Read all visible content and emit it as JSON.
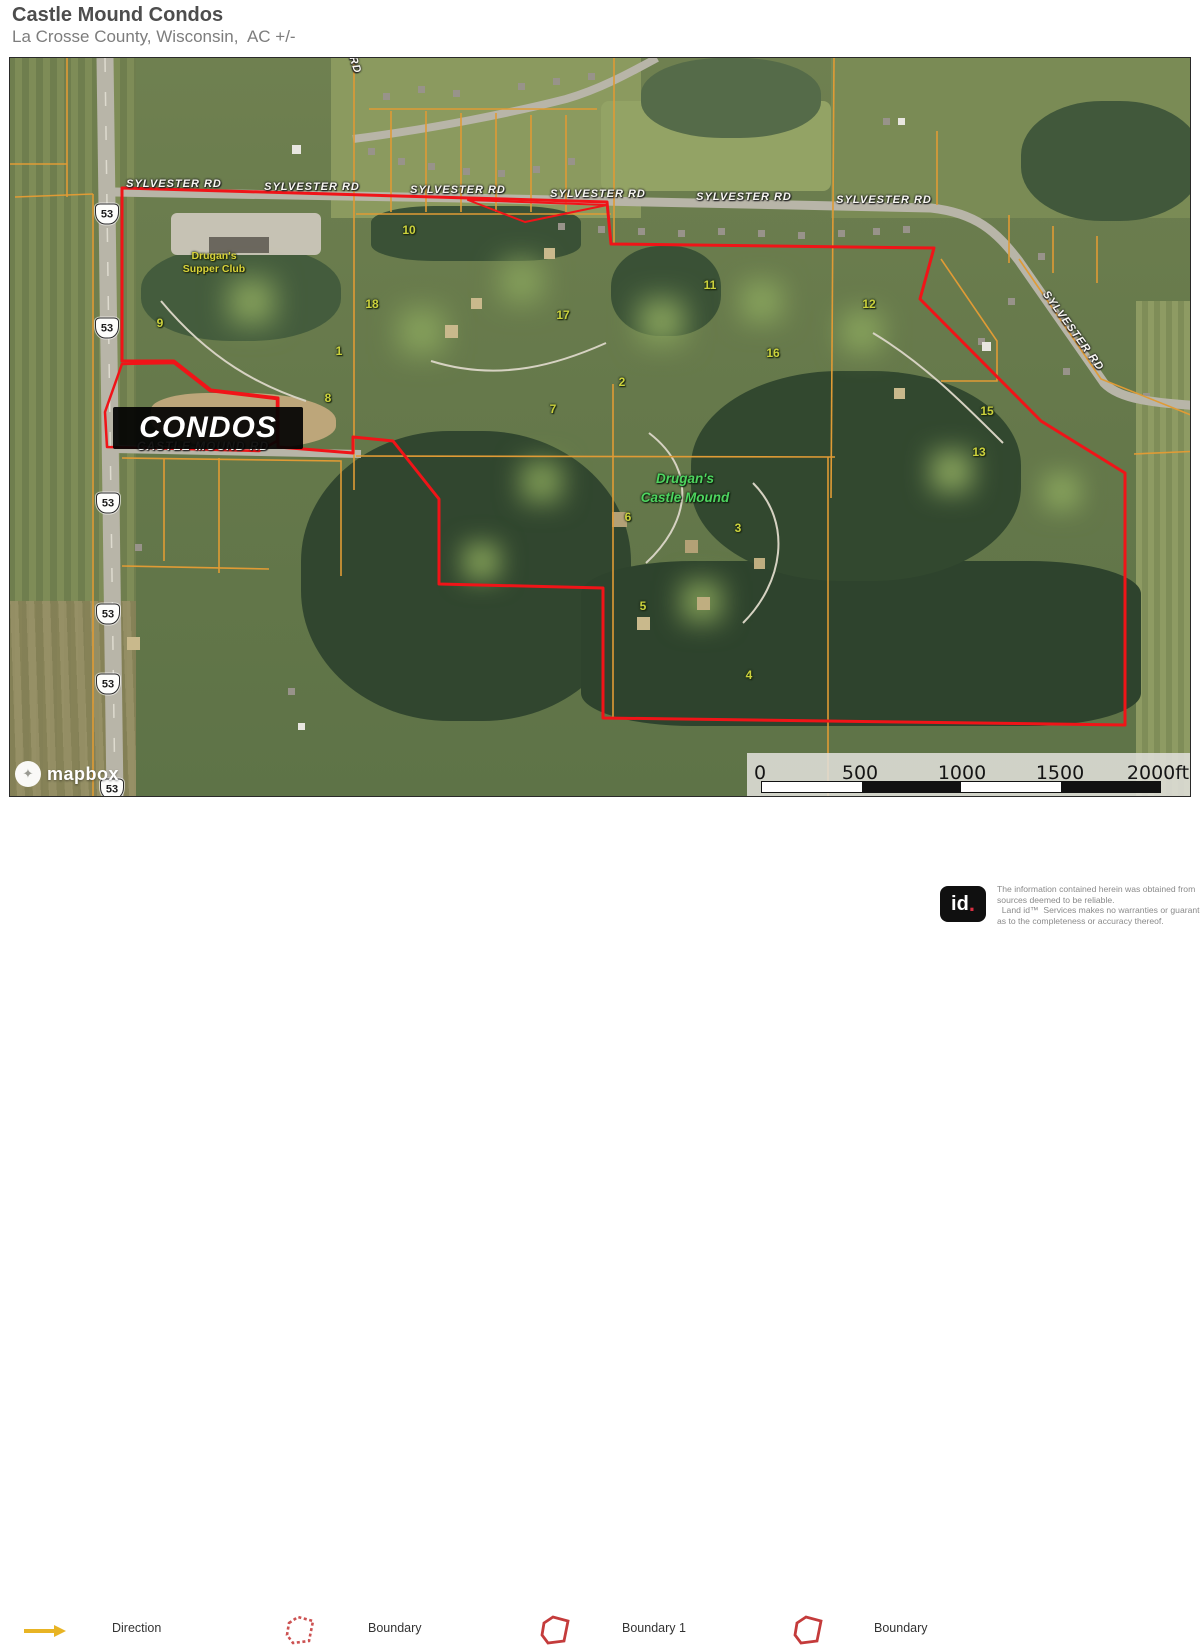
{
  "header": {
    "title": "Castle Mound Condos",
    "subtitle": "La Crosse County, Wisconsin,  AC +/-"
  },
  "map": {
    "labels": {
      "road": "SYLVESTER RD",
      "castle_mound_rd": "CASTLE MOUND RD",
      "rd_short": "RD",
      "condos": "CONDOS",
      "supper_club_1": "Drugan's",
      "supper_club_2": "Supper Club",
      "castle_mound_1": "Drugan's",
      "castle_mound_2": "Castle Mound",
      "shield": "53"
    },
    "hole_numbers": [
      "10",
      "18",
      "9",
      "1",
      "17",
      "2",
      "11",
      "12",
      "16",
      "15",
      "13",
      "7",
      "8",
      "6",
      "3",
      "5",
      "4"
    ],
    "colors": {
      "boundary_red": "#f01418",
      "parcel_orange": "#e09b35",
      "hole_yellow": "#ccd23c",
      "poi_green": "#4ed45f",
      "poi_yellow": "#d8d23a"
    },
    "geometry": {
      "boundary_main": "121,187 606,201 610,243 933,247 919,298 1040,420 1124,472 1124,724 602,717 602,587 438,583 438,498 392,440 352,436 352,452 277,446 277,397 210,389 173,360 121,360",
      "boundary_sliver": "467,199 606,204 524,221",
      "boundary_condos": "104,411 121,363 173,362 209,390 276,398 276,440 258,450 106,446",
      "parcel_lines": [
        "66,57 66,196",
        "0,163 66,163",
        "14,196 92,193",
        "92,193 92,795",
        "121,190 121,360",
        "353,57 353,489",
        "613,57 613,242",
        "355,213 610,213",
        "368,108 596,108",
        "390,110 390,211",
        "425,110 425,211",
        "460,112 460,211",
        "495,112 495,211",
        "530,114 530,211",
        "565,114 565,211",
        "833,57 830,497",
        "355,455 834,456",
        "1133,453 1200,450",
        "612,383 612,718",
        "827,456 827,795",
        "940,258 996,340 996,380 940,380",
        "1008,214 1008,262",
        "1052,225 1052,272",
        "1096,235 1096,282",
        "936,130 936,204",
        "1018,258 1100,378 1200,418",
        "121,457 340,460 340,575",
        "163,457 163,560",
        "218,457 218,572",
        "121,565 268,568"
      ]
    }
  },
  "scale_bar": {
    "labels": [
      "0",
      "500",
      "1000",
      "1500",
      "2000ft"
    ]
  },
  "attribution": {
    "brand": "mapbox"
  },
  "legend": {
    "items": [
      {
        "label": "Direction"
      },
      {
        "label": "Boundary"
      },
      {
        "label": "Boundary 1"
      },
      {
        "label": "Boundary"
      }
    ]
  },
  "footer": {
    "logo_text": "id",
    "logo_dot": ".",
    "disclaimer_lines": [
      "The information contained herein was obtained from",
      "sources deemed to be reliable.",
      "  Land id™  Services makes no warranties or guarantees",
      "as to the completeness or accuracy thereof."
    ]
  }
}
